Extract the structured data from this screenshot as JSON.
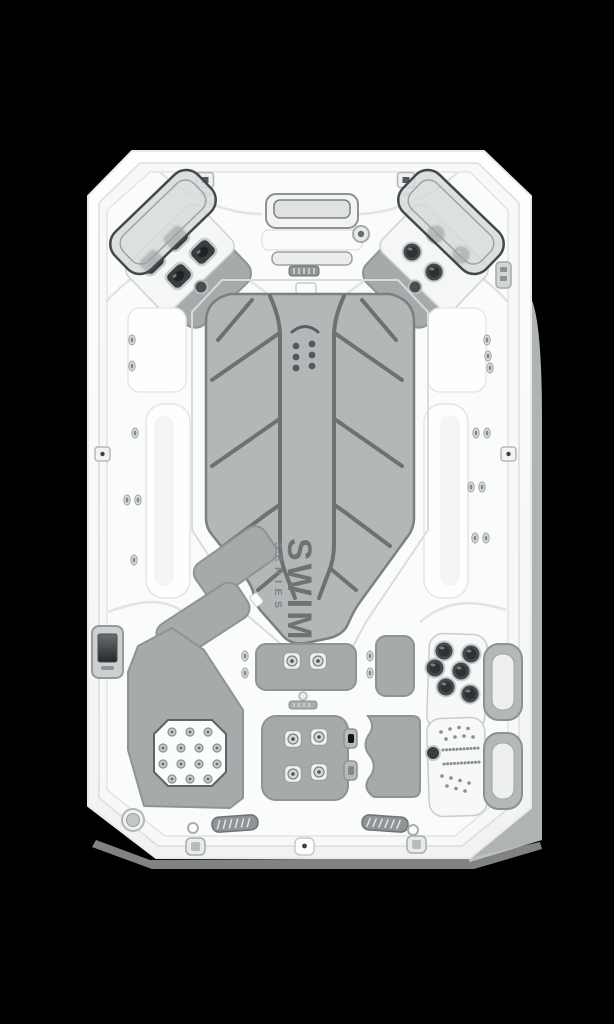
{
  "branding": {
    "logo_primary": "SWIM",
    "logo_secondary": "SERIES",
    "logo_color": "#6e7273",
    "logo_secondary_color": "#7e8284"
  },
  "colors": {
    "background": "#000000",
    "shell_white": "#fbfcfc",
    "interior_white": "#fafbfb",
    "pad_gray": "#a6aaab",
    "mat_gray": "#b4b7b8",
    "mat_line": "#6d7172",
    "pad_outline": "#8f9394",
    "jet_dark": "#3a3e40",
    "side_band_gray": "#b0b3b4",
    "screen_dark": "#35383a"
  }
}
